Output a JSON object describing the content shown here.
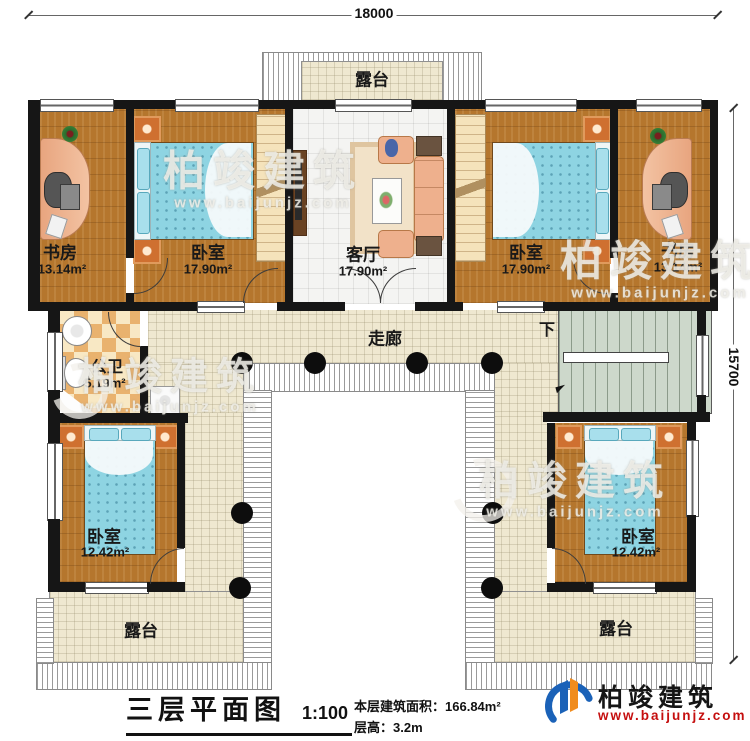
{
  "dimensions": {
    "width": "18000",
    "height": "15700"
  },
  "rooms": {
    "terrace_top": {
      "name": "露台"
    },
    "study_left": {
      "name": "书房",
      "area": "13.14m²"
    },
    "bedroom_top_left": {
      "name": "卧室",
      "area": "17.90m²"
    },
    "living_room": {
      "name": "客厅",
      "area": "17.90m²"
    },
    "bedroom_top_right": {
      "name": "卧室",
      "area": "17.90m²"
    },
    "study_right": {
      "name": "书房",
      "area": "13.14m²"
    },
    "bathroom": {
      "name": "公卫",
      "area": "5.19m²"
    },
    "corridor": {
      "name": "走廊"
    },
    "stairs": {
      "direction_label": "下"
    },
    "bedroom_bottom_left": {
      "name": "卧室",
      "area": "12.42m²"
    },
    "bedroom_bottom_right": {
      "name": "卧室",
      "area": "12.42m²"
    },
    "terrace_bottom_left": {
      "name": "露台"
    },
    "terrace_bottom_right": {
      "name": "露台"
    }
  },
  "footer": {
    "title": "三层平面图",
    "scale": "1:100",
    "area_label": "本层建筑面积：",
    "area_value": "166.84m²",
    "floor_height_label": "层高：",
    "floor_height_value": "3.2m"
  },
  "brand": {
    "name": "柏竣建筑",
    "website": "www.baijunjz.com"
  },
  "watermark": {
    "text": "柏竣建筑",
    "url": "www.baijunjz.com"
  },
  "colors": {
    "wall": "#161616",
    "wood": "#b5762d",
    "tile": "#efe8d0",
    "stairs": "#cdd8cb",
    "bed": "#8ed4e2",
    "brand_blue": "#1b62b8",
    "brand_orange": "#f08c1e",
    "url_red": "#c50f0f"
  }
}
